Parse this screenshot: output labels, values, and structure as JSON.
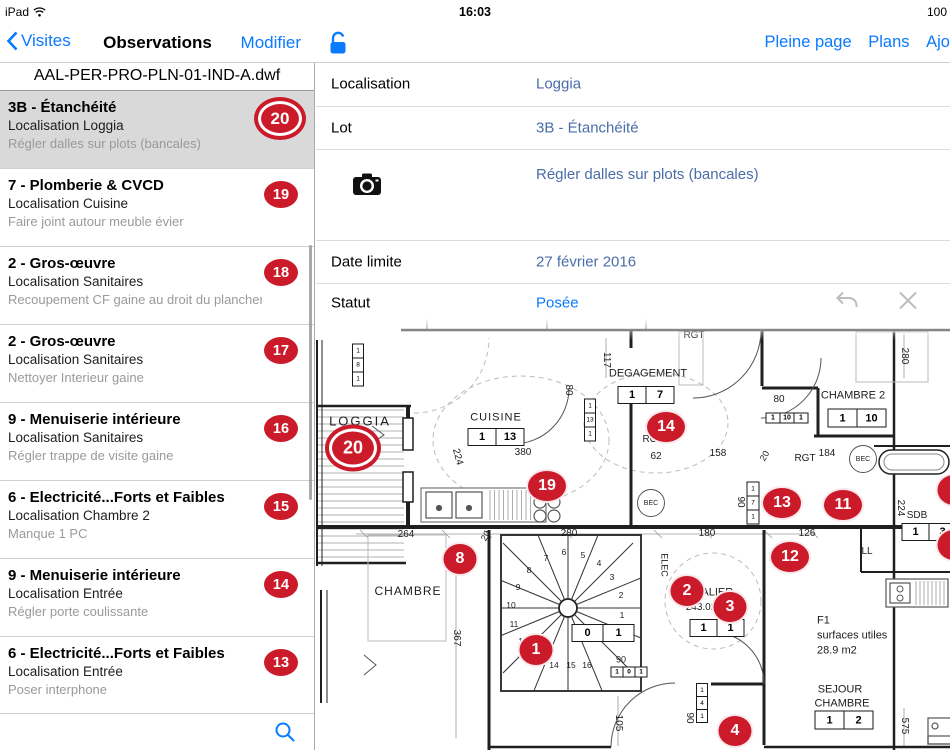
{
  "status_bar": {
    "device": "iPad",
    "time": "16:03",
    "battery": "100"
  },
  "nav": {
    "back_label": "Visites",
    "title": "Observations",
    "edit_label": "Modifier",
    "links": [
      "Pleine page",
      "Plans",
      "Ajo"
    ]
  },
  "sidebar": {
    "file_name": "AAL-PER-PRO-PLN-01-IND-A.dwf",
    "items": [
      {
        "title": "3B - Étanchéité",
        "location": "Localisation Loggia",
        "note": "Régler dalles sur plots (bancales)",
        "badge": "20",
        "selected": true
      },
      {
        "title": "7 - Plomberie & CVCD",
        "location": "Localisation Cuisine",
        "note": "Faire joint autour meuble évier",
        "badge": "19",
        "selected": false
      },
      {
        "title": "2 - Gros-œuvre",
        "location": "Localisation Sanitaires",
        "note": "Recoupement CF gaine au droit du plancher",
        "badge": "18",
        "selected": false
      },
      {
        "title": "2 - Gros-œuvre",
        "location": "Localisation Sanitaires",
        "note": "Nettoyer Interieur gaine",
        "badge": "17",
        "selected": false
      },
      {
        "title": "9 - Menuiserie intérieure",
        "location": "Localisation Sanitaires",
        "note": "Régler trappe de visite gaine",
        "badge": "16",
        "selected": false
      },
      {
        "title": "6 - Electricité...Forts et Faibles",
        "location": "Localisation Chambre 2",
        "note": "Manque 1 PC",
        "badge": "15",
        "selected": false
      },
      {
        "title": "9 - Menuiserie intérieure",
        "location": "Localisation Entrée",
        "note": "Régler porte coulissante",
        "badge": "14",
        "selected": false
      },
      {
        "title": "6 - Electricité...Forts et Faibles",
        "location": "Localisation Entrée",
        "note": "Poser interphone",
        "badge": "13",
        "selected": false
      }
    ]
  },
  "detail": {
    "rows": [
      {
        "label": "Localisation",
        "value": "Loggia"
      },
      {
        "label": "Lot",
        "value": "3B - Étanchéité"
      },
      {
        "label": "",
        "value": "Régler dalles sur plots (bancales)"
      },
      {
        "label": "Date limite",
        "value": "27 février 2016"
      },
      {
        "label": "Statut",
        "value": "Posée"
      }
    ]
  },
  "colors": {
    "accent_blue": "#0a7aff",
    "value_blue": "#4a6da7",
    "badge_red": "#cb1b2a",
    "selected_row": "#d9d9d9"
  },
  "plan": {
    "badges": [
      {
        "n": "20",
        "x": 37,
        "y": 130,
        "selected": true
      },
      {
        "n": "19",
        "x": 231,
        "y": 168
      },
      {
        "n": "14",
        "x": 350,
        "y": 109
      },
      {
        "n": "13",
        "x": 466,
        "y": 185
      },
      {
        "n": "11",
        "x": 527,
        "y": 187
      },
      {
        "n": "12",
        "x": 474,
        "y": 239
      },
      {
        "n": "8",
        "x": 144,
        "y": 241
      },
      {
        "n": "2",
        "x": 371,
        "y": 273
      },
      {
        "n": "3",
        "x": 414,
        "y": 289
      },
      {
        "n": "1",
        "x": 220,
        "y": 332
      },
      {
        "n": "4",
        "x": 419,
        "y": 413
      },
      {
        "n": "1",
        "x": 638,
        "y": 172,
        "clipped": true
      },
      {
        "n": "9",
        "x": 638,
        "y": 227,
        "clipped": true
      }
    ],
    "labels": [
      {
        "t": "LOGGIA",
        "x": 44,
        "y": 103,
        "s": 13,
        "ls": 2
      },
      {
        "t": "CUISINE",
        "x": 180,
        "y": 100,
        "s": 11,
        "ls": 1
      },
      {
        "t": "RGT",
        "x": 378,
        "y": 18,
        "s": 10
      },
      {
        "t": "117",
        "x": 290,
        "y": 42,
        "s": 10,
        "r": 90
      },
      {
        "t": "DEGAGEMENT",
        "x": 332,
        "y": 56,
        "s": 11
      },
      {
        "t": "80",
        "x": 463,
        "y": 82,
        "s": 10
      },
      {
        "t": "CHAMBRE 2",
        "x": 537,
        "y": 78,
        "s": 11
      },
      {
        "t": "280",
        "x": 588,
        "y": 38,
        "s": 10,
        "r": 90
      },
      {
        "t": "RGT",
        "x": 337,
        "y": 122,
        "s": 10
      },
      {
        "t": "62",
        "x": 340,
        "y": 139,
        "s": 10
      },
      {
        "t": "158",
        "x": 402,
        "y": 136,
        "s": 10
      },
      {
        "t": "20",
        "x": 449,
        "y": 138,
        "s": 9,
        "r": -60
      },
      {
        "t": "RGT",
        "x": 489,
        "y": 141,
        "s": 10
      },
      {
        "t": "184",
        "x": 511,
        "y": 136,
        "s": 10
      },
      {
        "t": "90",
        "x": 424,
        "y": 184,
        "s": 10,
        "r": 90
      },
      {
        "t": "126",
        "x": 491,
        "y": 216,
        "s": 10
      },
      {
        "t": "180",
        "x": 391,
        "y": 216,
        "s": 10
      },
      {
        "t": "264",
        "x": 90,
        "y": 217,
        "s": 10
      },
      {
        "t": "20",
        "x": 170,
        "y": 218,
        "s": 9,
        "r": -60
      },
      {
        "t": "280",
        "x": 253,
        "y": 216,
        "s": 10
      },
      {
        "t": "224",
        "x": 141,
        "y": 139,
        "s": 10,
        "r": 75
      },
      {
        "t": "380",
        "x": 207,
        "y": 135,
        "s": 10
      },
      {
        "t": "80",
        "x": 252,
        "y": 72,
        "s": 10,
        "r": 90
      },
      {
        "t": "BEC",
        "x": 547,
        "y": 141,
        "s": 7,
        "circle": 14
      },
      {
        "t": "BEC",
        "x": 335,
        "y": 185,
        "s": 7,
        "circle": 14
      },
      {
        "t": "CHAMBRE",
        "x": 92,
        "y": 273,
        "s": 12,
        "ls": 1
      },
      {
        "t": "367",
        "x": 140,
        "y": 320,
        "s": 10,
        "r": 90
      },
      {
        "t": "ELEC",
        "x": 348,
        "y": 247,
        "s": 9,
        "r": 90
      },
      {
        "t": "PALIER",
        "x": 398,
        "y": 275,
        "s": 11
      },
      {
        "t": "243.02",
        "x": 385,
        "y": 290,
        "s": 10
      },
      {
        "t": "SDB",
        "x": 601,
        "y": 198,
        "s": 10
      },
      {
        "t": "224",
        "x": 584,
        "y": 190,
        "s": 10,
        "r": 90
      },
      {
        "t": "LL",
        "x": 551,
        "y": 234,
        "s": 10
      },
      {
        "t": "90",
        "x": 305,
        "y": 342,
        "s": 9
      },
      {
        "t": "105",
        "x": 302,
        "y": 405,
        "s": 10,
        "r": 90
      },
      {
        "t": "90",
        "x": 373,
        "y": 400,
        "s": 10,
        "r": 90
      },
      {
        "t": "F1",
        "x": 501,
        "y": 303,
        "s": 11,
        "left": true
      },
      {
        "t": "surfaces utiles",
        "x": 501,
        "y": 318,
        "s": 11,
        "left": true
      },
      {
        "t": "28.9 m2",
        "x": 501,
        "y": 333,
        "s": 11,
        "left": true
      },
      {
        "t": "SEJOUR",
        "x": 524,
        "y": 372,
        "s": 11
      },
      {
        "t": "CHAMBRE",
        "x": 526,
        "y": 386,
        "s": 11
      },
      {
        "t": "575",
        "x": 588,
        "y": 408,
        "s": 10,
        "r": 90
      }
    ],
    "tables": [
      {
        "cells": [
          "1",
          "13"
        ],
        "x": 180,
        "y": 119,
        "cw": 27,
        "ch": 16,
        "fs": 11
      },
      {
        "cells": [
          "1",
          "7"
        ],
        "x": 330,
        "y": 77,
        "cw": 27,
        "ch": 16,
        "fs": 11
      },
      {
        "cells": [
          "1",
          "10",
          "1"
        ],
        "x": 471,
        "y": 100,
        "cw": 13,
        "ch": 9,
        "fs": 7
      },
      {
        "cells": [
          "1",
          "10"
        ],
        "x": 541,
        "y": 100,
        "cw": 28,
        "ch": 17,
        "fs": 11
      },
      {
        "cells": [
          "1",
          "3"
        ],
        "x": 613,
        "y": 214,
        "cw": 26,
        "ch": 16,
        "fs": 11
      },
      {
        "cells": [
          "1",
          "1"
        ],
        "x": 401,
        "y": 310,
        "cw": 26,
        "ch": 16,
        "fs": 11
      },
      {
        "cells": [
          "0",
          "1"
        ],
        "x": 287,
        "y": 315,
        "cw": 30,
        "ch": 16,
        "fs": 11
      },
      {
        "cells": [
          "1",
          "0",
          "1"
        ],
        "x": 313,
        "y": 354,
        "cw": 11,
        "ch": 9,
        "fs": 6.5
      },
      {
        "cells": [
          "1",
          "2"
        ],
        "x": 528,
        "y": 402,
        "cw": 28,
        "ch": 17,
        "fs": 11
      },
      {
        "cells": [
          "1",
          "8",
          "1"
        ],
        "x": 42,
        "y": 47,
        "cw": 10,
        "ch": 13,
        "fs": 6.5,
        "v": true
      },
      {
        "cells": [
          "1",
          "13",
          "1"
        ],
        "x": 274,
        "y": 102,
        "cw": 10,
        "ch": 13,
        "fs": 6.5,
        "v": true
      },
      {
        "cells": [
          "1",
          "7",
          "1"
        ],
        "x": 437,
        "y": 185,
        "cw": 11,
        "ch": 13,
        "fs": 6.5,
        "v": true
      },
      {
        "cells": [
          "1",
          "4",
          "1"
        ],
        "x": 386,
        "y": 385,
        "cw": 10,
        "ch": 12,
        "fs": 6.5,
        "v": true
      }
    ],
    "stair_steps": [
      {
        "n": "1",
        "x": 306,
        "y": 297
      },
      {
        "n": "2",
        "x": 305,
        "y": 277
      },
      {
        "n": "3",
        "x": 296,
        "y": 259
      },
      {
        "n": "4",
        "x": 283,
        "y": 245
      },
      {
        "n": "5",
        "x": 267,
        "y": 237
      },
      {
        "n": "6",
        "x": 248,
        "y": 234
      },
      {
        "n": "7",
        "x": 230,
        "y": 240
      },
      {
        "n": "8",
        "x": 213,
        "y": 252
      },
      {
        "n": "9",
        "x": 202,
        "y": 269
      },
      {
        "n": "10",
        "x": 195,
        "y": 287
      },
      {
        "n": "11",
        "x": 198,
        "y": 306
      },
      {
        "n": "12",
        "x": 207,
        "y": 323
      },
      {
        "n": "13",
        "x": 221,
        "y": 336
      },
      {
        "n": "14",
        "x": 238,
        "y": 347
      },
      {
        "n": "15",
        "x": 255,
        "y": 347
      },
      {
        "n": "16",
        "x": 271,
        "y": 347
      }
    ]
  }
}
